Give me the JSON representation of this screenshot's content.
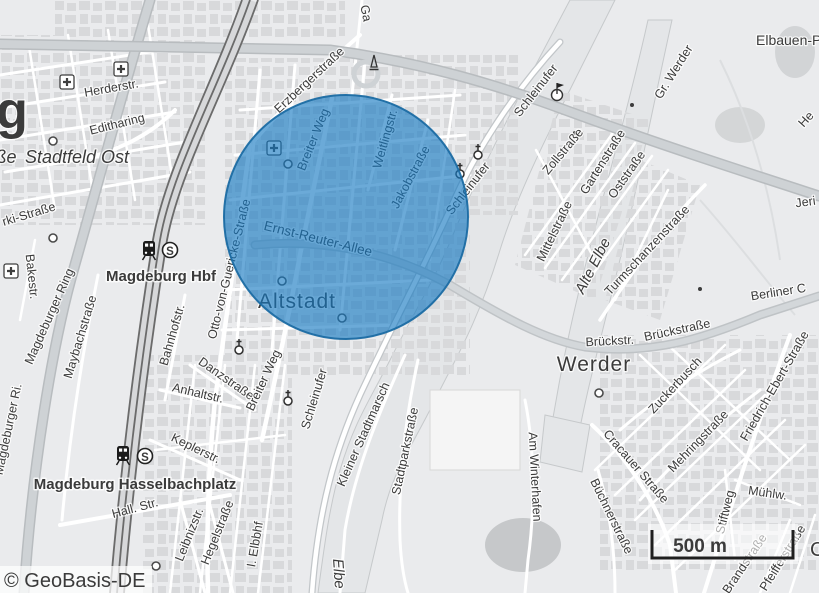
{
  "map": {
    "attribution": "© GeoBasis-DE",
    "scale_bar": {
      "label": "500 m"
    },
    "icon_glyphs": {
      "sbahn": "S"
    },
    "overlay_circle": {
      "fill": "#1478c2",
      "fill_opacity": "0.63",
      "stroke": "#1b6ca3"
    },
    "colors": {
      "base": "#eaebed",
      "building": "#d8d9db",
      "road_major": "#ced2d5",
      "water": "#e4e6e8",
      "rail": "#6b6b6b",
      "accent_blue": "#1f78b4"
    },
    "station_labels": [
      {
        "text": "Magdeburg Hbf",
        "x": 161,
        "y": 281,
        "size": 15,
        "weight": 700,
        "color": "#141414"
      },
      {
        "text": "Magdeburg Hasselbachplatz",
        "x": 135,
        "y": 489,
        "size": 15,
        "weight": 700,
        "color": "#141414"
      }
    ],
    "place_labels": [
      {
        "text": "g",
        "x": 12,
        "y": 128,
        "size": 52,
        "weight": 700,
        "color": "#2d2d2d",
        "name": "city-label-fragment"
      },
      {
        "text": "ße",
        "x": 6,
        "y": 163,
        "size": 18,
        "italic": true,
        "color": "#3c3c3c",
        "name": "street-label-fragment"
      },
      {
        "text": "Stadtfeld Ost",
        "x": 77,
        "y": 163,
        "size": 18,
        "italic": true,
        "color": "#3c3c3c",
        "name": "district-label"
      },
      {
        "text": "Altstadt",
        "x": 297,
        "y": 308,
        "size": 21,
        "ls": 1,
        "color": "#33495a",
        "name": "district-label"
      },
      {
        "text": "Werder",
        "x": 594,
        "y": 371,
        "size": 21,
        "ls": 1,
        "color": "#2e2e2e",
        "name": "district-label"
      },
      {
        "text": "Elbauen-P",
        "x": 756,
        "y": 45,
        "size": 14,
        "anchor": "start",
        "color": "#8c8c8c",
        "name": "area-label"
      },
      {
        "text": "Alte Elbe",
        "x": 597,
        "y": 268,
        "r": -63,
        "size": 15,
        "italic": true,
        "color": "#9ca0a2",
        "name": "water-label"
      },
      {
        "text": "Elbe",
        "x": 334,
        "y": 574,
        "r": 86,
        "size": 15,
        "italic": true,
        "color": "#9ca0a2",
        "name": "water-label"
      },
      {
        "text": "C",
        "x": 810,
        "y": 556,
        "size": 20,
        "anchor": "start",
        "color": "#2e2e2e",
        "name": "place-label-fragment"
      }
    ],
    "street_labels": [
      {
        "text": "Herderstr.",
        "x": 112,
        "y": 92,
        "r": -10
      },
      {
        "text": "Editharing",
        "x": 118,
        "y": 128,
        "r": -14
      },
      {
        "text": "Erzbergerstraße",
        "x": 312,
        "y": 83,
        "r": -43
      },
      {
        "text": "Ga",
        "x": 362,
        "y": 14,
        "r": 78
      },
      {
        "text": "Breiter Weg",
        "x": 317,
        "y": 141,
        "r": -68
      },
      {
        "text": "Weitlingstr.",
        "x": 389,
        "y": 140,
        "r": -74
      },
      {
        "text": "Jakobstraße",
        "x": 414,
        "y": 179,
        "r": -62
      },
      {
        "text": "Ernst-Reuter-Allee",
        "x": 317,
        "y": 243,
        "r": 14,
        "size": 13.5
      },
      {
        "text": "Schleinufer",
        "x": 539,
        "y": 93,
        "r": -52
      },
      {
        "text": "Schleinufer",
        "x": 471,
        "y": 191,
        "r": -52
      },
      {
        "text": "Schleinufer",
        "x": 318,
        "y": 400,
        "r": -73
      },
      {
        "text": "Otto-von-Guericke-Straße",
        "x": 233,
        "y": 270,
        "r": -76
      },
      {
        "text": "Bahnhofstr.",
        "x": 176,
        "y": 336,
        "r": -74
      },
      {
        "text": "Maybachstraße",
        "x": 84,
        "y": 338,
        "r": -73
      },
      {
        "text": "Magdeburger Ring",
        "x": 53,
        "y": 318,
        "r": -66
      },
      {
        "text": "Magdeburger Ri.",
        "x": 12,
        "y": 430,
        "r": -78
      },
      {
        "text": "Bakestr.",
        "x": 28,
        "y": 277,
        "r": 84
      },
      {
        "text": "rki-Straße",
        "x": 30,
        "y": 218,
        "r": -17
      },
      {
        "text": "Zollstraße",
        "x": 566,
        "y": 154,
        "r": -50
      },
      {
        "text": "Mittelstraße",
        "x": 558,
        "y": 233,
        "r": -64
      },
      {
        "text": "Gartenstraße",
        "x": 606,
        "y": 164,
        "r": -58
      },
      {
        "text": "Oststraße",
        "x": 630,
        "y": 177,
        "r": -55
      },
      {
        "text": "Turmschanzenstraße",
        "x": 650,
        "y": 253,
        "r": -47
      },
      {
        "text": "Gr. Werder",
        "x": 677,
        "y": 74,
        "r": -58
      },
      {
        "text": "Jeri",
        "x": 806,
        "y": 206,
        "r": -8
      },
      {
        "text": "He",
        "x": 809,
        "y": 122,
        "r": -48
      },
      {
        "text": "Berliner C",
        "x": 779,
        "y": 296,
        "r": -9
      },
      {
        "text": "Brückstr.",
        "x": 610,
        "y": 345,
        "r": -3
      },
      {
        "text": "Brückstraße",
        "x": 678,
        "y": 334,
        "r": -12
      },
      {
        "text": "Zuckerbusch",
        "x": 678,
        "y": 388,
        "r": -47
      },
      {
        "text": "Cracauer Straße",
        "x": 633,
        "y": 469,
        "r": 49
      },
      {
        "text": "Mehringstraße",
        "x": 701,
        "y": 444,
        "r": -46
      },
      {
        "text": "Friedrich-Ebert-Straße",
        "x": 778,
        "y": 388,
        "r": -60
      },
      {
        "text": "Büchnerstraße",
        "x": 608,
        "y": 518,
        "r": 64
      },
      {
        "text": "Mühlw.",
        "x": 767,
        "y": 497,
        "r": 8
      },
      {
        "text": "Stiftweg",
        "x": 729,
        "y": 513,
        "r": -76
      },
      {
        "text": "Brandstraße",
        "x": 748,
        "y": 566,
        "r": -56
      },
      {
        "text": "Pfeifferstraße",
        "x": 786,
        "y": 560,
        "r": -58,
        "color": "#9a9a9a"
      },
      {
        "text": "Am Winterhafen",
        "x": 531,
        "y": 477,
        "r": 87
      },
      {
        "text": "Kleiner Stadtmarsch",
        "x": 367,
        "y": 436,
        "r": -66
      },
      {
        "text": "Stadtparkstraße",
        "x": 409,
        "y": 452,
        "r": -78
      },
      {
        "text": "Keplerstr.",
        "x": 194,
        "y": 452,
        "r": 26
      },
      {
        "text": "Hall. Str.",
        "x": 136,
        "y": 512,
        "r": -15
      },
      {
        "text": "Leibnizstr.",
        "x": 193,
        "y": 536,
        "r": -68
      },
      {
        "text": "Hegelstraße",
        "x": 221,
        "y": 534,
        "r": -68
      },
      {
        "text": "I. Elbbhf",
        "x": 259,
        "y": 545,
        "r": -80
      },
      {
        "text": "Anhaltstr.",
        "x": 197,
        "y": 397,
        "r": 13
      },
      {
        "text": "Danzstraße",
        "x": 224,
        "y": 382,
        "r": 35
      },
      {
        "text": "Breiter Weg",
        "x": 267,
        "y": 382,
        "r": -65
      }
    ],
    "icons": [
      {
        "type": "hospital",
        "x": 67,
        "y": 82
      },
      {
        "type": "hospital",
        "x": 121,
        "y": 69
      },
      {
        "type": "hospital",
        "x": 11,
        "y": 271
      },
      {
        "type": "hospital",
        "x": 274,
        "y": 148
      },
      {
        "type": "church",
        "x": 478,
        "y": 155
      },
      {
        "type": "church",
        "x": 460,
        "y": 174
      },
      {
        "type": "church",
        "x": 239,
        "y": 350
      },
      {
        "type": "church",
        "x": 288,
        "y": 401
      },
      {
        "type": "monument",
        "x": 374,
        "y": 64
      },
      {
        "type": "flag",
        "x": 557,
        "y": 95
      },
      {
        "type": "train",
        "x": 149,
        "y": 250
      },
      {
        "type": "sbahn",
        "x": 170,
        "y": 250
      },
      {
        "type": "train",
        "x": 123,
        "y": 455
      },
      {
        "type": "sbahn",
        "x": 145,
        "y": 456
      },
      {
        "type": "poi",
        "x": 282,
        "y": 281
      },
      {
        "type": "poi",
        "x": 288,
        "y": 164
      },
      {
        "type": "poi",
        "x": 342,
        "y": 318
      },
      {
        "type": "poi",
        "x": 156,
        "y": 566
      },
      {
        "type": "poi",
        "x": 599,
        "y": 393
      },
      {
        "type": "poi",
        "x": 53,
        "y": 141
      },
      {
        "type": "poi",
        "x": 53,
        "y": 238
      },
      {
        "type": "dot",
        "x": 632,
        "y": 105
      },
      {
        "type": "dot",
        "x": 575,
        "y": 133
      },
      {
        "type": "dot",
        "x": 700,
        "y": 289
      }
    ]
  }
}
